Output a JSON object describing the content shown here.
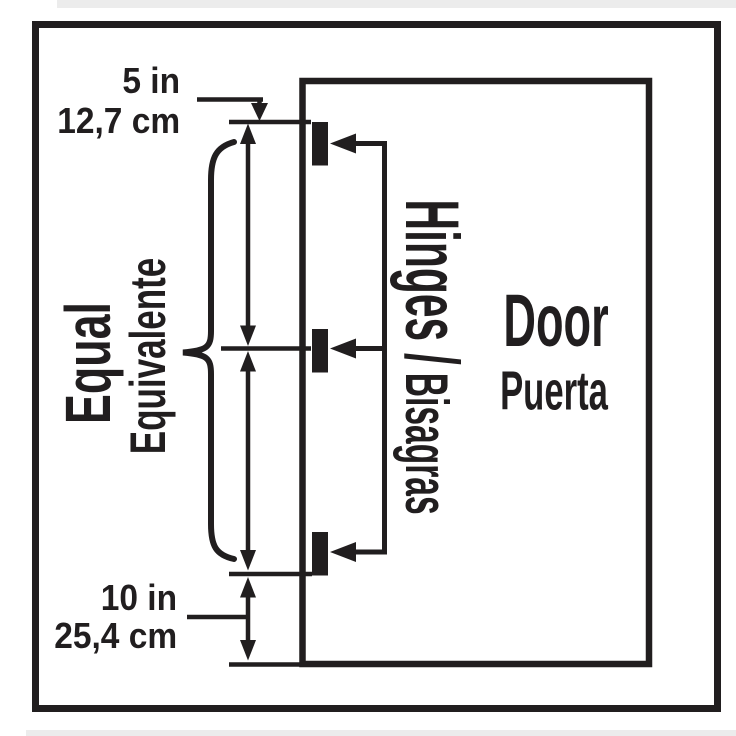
{
  "diagram": {
    "colors": {
      "ink": "#211e1f",
      "background": "#ffffff"
    },
    "door": {
      "label_en": "Door",
      "label_es": "Puerta"
    },
    "hinges": {
      "label_en": "Hinges /",
      "label_es": "Bisagras",
      "count": 3
    },
    "spacing": {
      "label_en": "Equal",
      "label_es": "Equivalente"
    },
    "dimensions": {
      "top_offset": {
        "imperial": "5 in",
        "metric": "12,7 cm"
      },
      "bottom_offset": {
        "imperial": "10 in",
        "metric": "25,4 cm"
      }
    }
  }
}
